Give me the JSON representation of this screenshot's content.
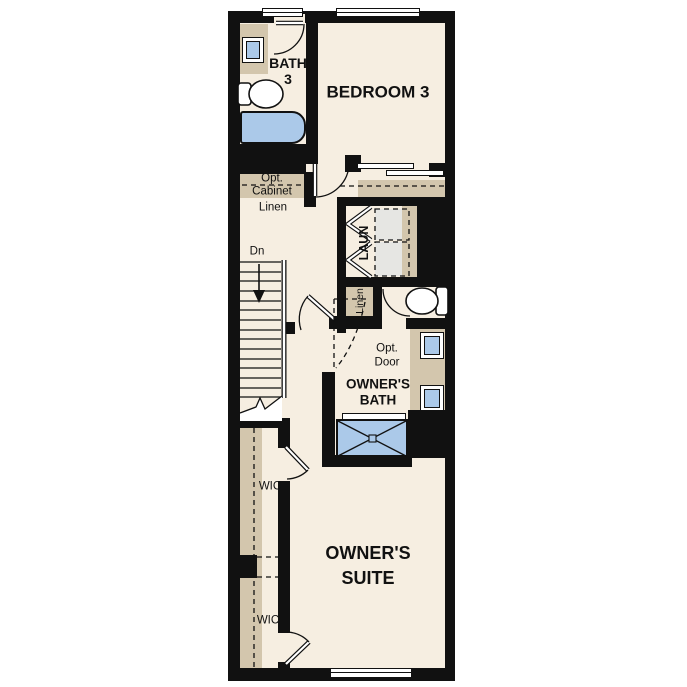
{
  "title": "Floor plan - upper level",
  "colors": {
    "wall": "#111111",
    "floor": "#f6eee1",
    "cabinet_tan": "#d3c6ad",
    "fixture_blue": "#abc9e9",
    "appliance_gray": "#e6e6e3"
  },
  "rooms": {
    "bedroom3": {
      "label": "BEDROOM 3"
    },
    "bath3": {
      "line1": "BATH",
      "line2": "3"
    },
    "owners_suite": {
      "line1": "OWNER'S",
      "line2": "SUITE"
    },
    "owners_bath": {
      "line1": "OWNER'S",
      "line2": "BATH"
    },
    "laundry": {
      "label": "LAUN"
    },
    "wic_upper": {
      "label": "WIC"
    },
    "wic_lower": {
      "label": "WIC"
    },
    "linen_hall": {
      "label": "Linen"
    },
    "linen_closet": {
      "label": "Linen"
    },
    "opt_cabinet": {
      "line1": "Opt.",
      "line2": "Cabinet"
    },
    "opt_door": {
      "line1": "Opt.",
      "line2": "Door"
    },
    "stairs": {
      "down_label": "Dn"
    }
  }
}
